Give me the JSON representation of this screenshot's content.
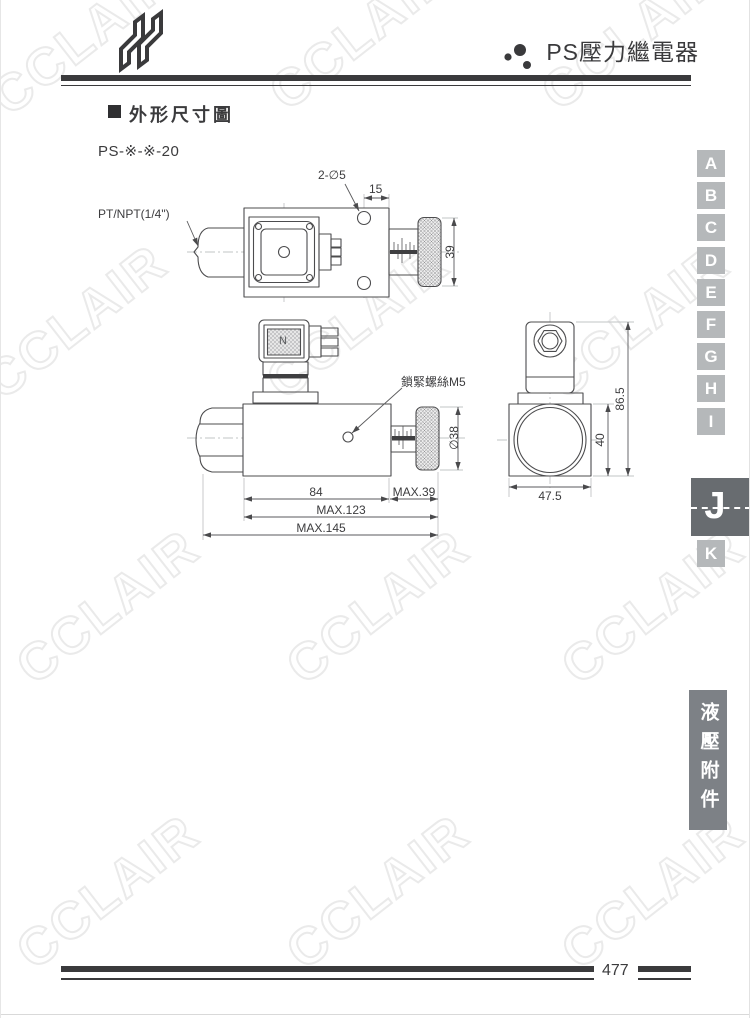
{
  "header": {
    "title": "PS壓力繼電器",
    "logo_icon": "stylized-N-ribbon",
    "title_bullet_icon": "three-dots-cluster"
  },
  "section": {
    "heading": "外形尺寸圖",
    "model": "PS-※-※-20"
  },
  "drawing": {
    "port_label": "PT/NPT(1/4\")",
    "holes_label": "2-∅5",
    "dim_15": "15",
    "dim_39": "39",
    "lock_screw_label": "鎖緊螺絲M5",
    "dim_knob_dia": "∅38",
    "dim_84": "84",
    "dim_max39": "MAX.39",
    "dim_max123": "MAX.123",
    "dim_max145": "MAX.145",
    "dim_47_5": "47.5",
    "dim_40": "40",
    "dim_86_5": "86.5",
    "connector_label": "N"
  },
  "index_tabs": {
    "items": [
      "A",
      "B",
      "C",
      "D",
      "E",
      "F",
      "G",
      "H",
      "I",
      "J",
      "K"
    ],
    "active": "J"
  },
  "side_label": "液壓附件",
  "footer": {
    "page_number": "477"
  },
  "watermark": {
    "text": "CCLAIR"
  },
  "colors": {
    "ink": "#3a3a3c",
    "tab_gray": "#b5b8ba",
    "tab_active": "#686c70",
    "side_box": "#7d8186",
    "watermark_outline": "#eaeaea"
  }
}
